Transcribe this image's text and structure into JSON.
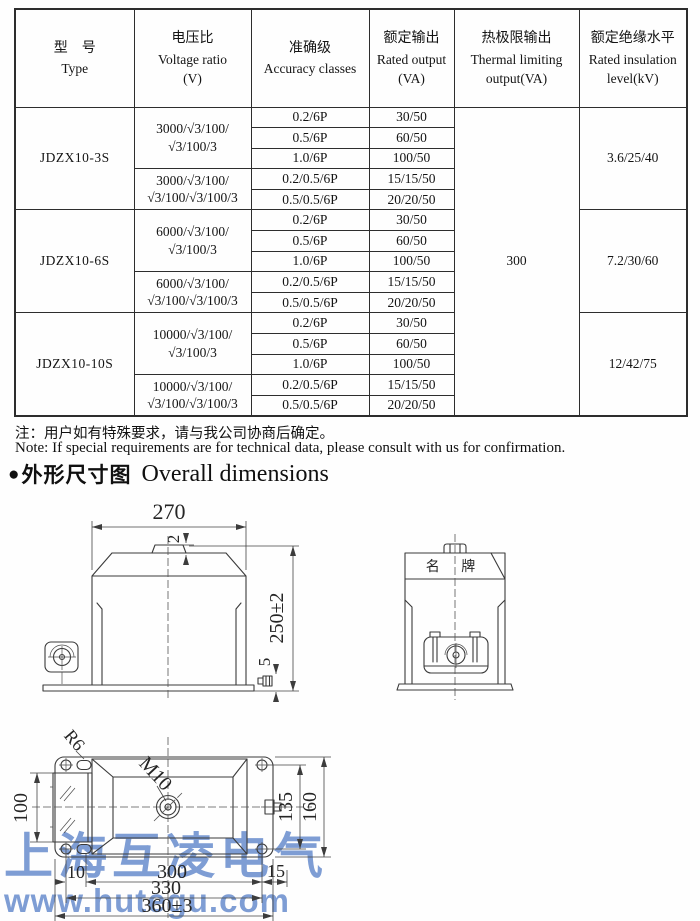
{
  "table": {
    "headers": [
      {
        "lines": [
          "型　号",
          "Type"
        ]
      },
      {
        "lines": [
          "电压比",
          "Voltage ratio",
          "(V)"
        ]
      },
      {
        "lines": [
          "准确级",
          "Accuracy classes"
        ]
      },
      {
        "lines": [
          "额定输出",
          "Rated output",
          "(VA)"
        ]
      },
      {
        "lines": [
          "热极限输出",
          "Thermal limiting",
          "output(VA)"
        ]
      },
      {
        "lines": [
          "额定绝缘水平",
          "Rated insulation",
          "level(kV)"
        ]
      }
    ],
    "thermal_output": "300",
    "groups": [
      {
        "type": "JDZX10-3S",
        "insulation": "3.6/25/40",
        "subgroups": [
          {
            "voltage": [
              "3000/√3/100/",
              "√3/100/3"
            ],
            "rows": [
              [
                "0.2/6P",
                "30/50"
              ],
              [
                "0.5/6P",
                "60/50"
              ],
              [
                "1.0/6P",
                "100/50"
              ]
            ]
          },
          {
            "voltage": [
              "3000/√3/100/",
              "√3/100/√3/100/3"
            ],
            "rows": [
              [
                "0.2/0.5/6P",
                "15/15/50"
              ],
              [
                "0.5/0.5/6P",
                "20/20/50"
              ]
            ]
          }
        ]
      },
      {
        "type": "JDZX10-6S",
        "insulation": "7.2/30/60",
        "subgroups": [
          {
            "voltage": [
              "6000/√3/100/",
              "√3/100/3"
            ],
            "rows": [
              [
                "0.2/6P",
                "30/50"
              ],
              [
                "0.5/6P",
                "60/50"
              ],
              [
                "1.0/6P",
                "100/50"
              ]
            ]
          },
          {
            "voltage": [
              "6000/√3/100/",
              "√3/100/√3/100/3"
            ],
            "rows": [
              [
                "0.2/0.5/6P",
                "15/15/50"
              ],
              [
                "0.5/0.5/6P",
                "20/20/50"
              ]
            ]
          }
        ]
      },
      {
        "type": "JDZX10-10S",
        "insulation": "12/42/75",
        "subgroups": [
          {
            "voltage": [
              "10000/√3/100/",
              "√3/100/3"
            ],
            "rows": [
              [
                "0.2/6P",
                "30/50"
              ],
              [
                "0.5/6P",
                "60/50"
              ],
              [
                "1.0/6P",
                "100/50"
              ]
            ]
          },
          {
            "voltage": [
              "10000/√3/100/",
              "√3/100/√3/100/3"
            ],
            "rows": [
              [
                "0.2/0.5/6P",
                "15/15/50"
              ],
              [
                "0.5/0.5/6P",
                "20/20/50"
              ]
            ]
          }
        ]
      }
    ]
  },
  "notes": {
    "cn": "注：用户如有特殊要求，请与我公司协商后确定。",
    "en": "Note: If special requirements are for technical data, please consult with us for confirmation."
  },
  "section": {
    "bullet": "●",
    "title_cn": "外形尺寸图",
    "title_en": "Overall dimensions"
  },
  "drawings": {
    "front": {
      "dim_width": "270",
      "dim_cap": "2",
      "dim_height": "250±2",
      "dim_base_bolt": "5"
    },
    "side": {
      "nameplate": "名 牌"
    },
    "plan": {
      "dim_r6": "R6",
      "dim_m10": "M10",
      "dim_left": "100",
      "dim_inner": "135",
      "dim_outer": "160",
      "dim_offset_left": "10",
      "dim_body": "300",
      "dim_offset_right": "15",
      "dim_holes": "330",
      "dim_total": "360±3"
    }
  },
  "watermark": {
    "line1": "上海互凌电气",
    "line2": "www.hutegu.com",
    "color": "#6d90cf"
  }
}
